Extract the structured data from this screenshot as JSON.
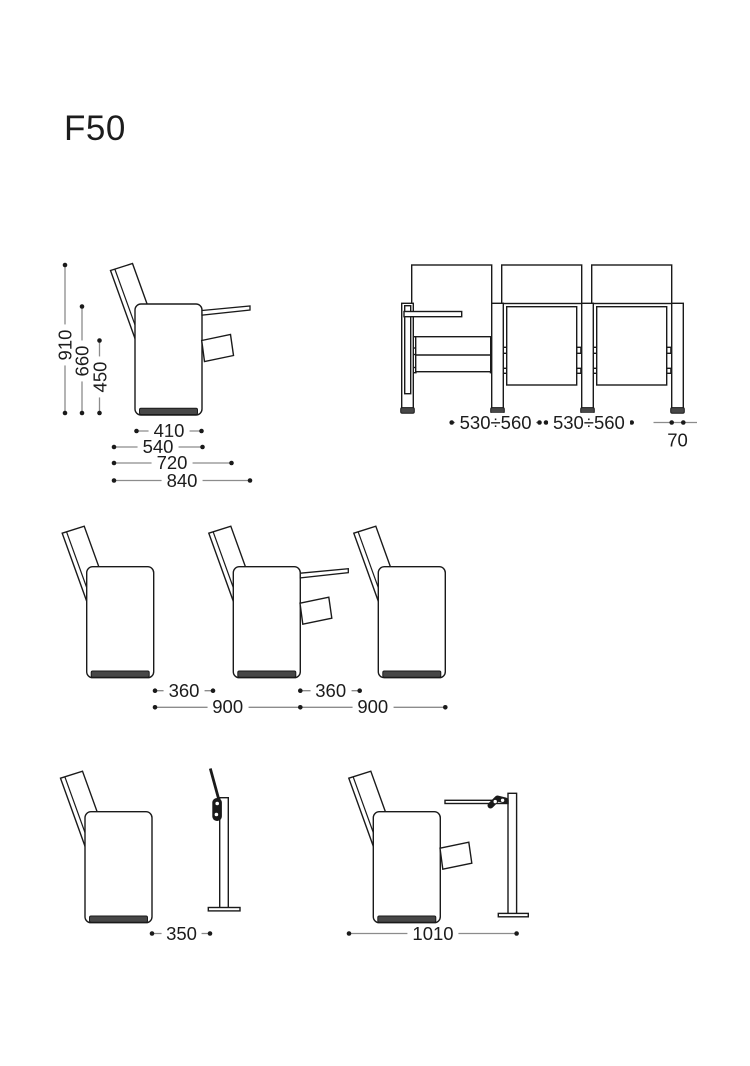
{
  "title": "F50",
  "colors": {
    "line": "#1a1a1a",
    "dim_line": "#8c8c8c",
    "text": "#1c1c1c",
    "base_fill": "#474747",
    "background": "#ffffff"
  },
  "dims": {
    "total_height": "910",
    "armrest_height": "660",
    "seat_height": "450",
    "body_depth": "410",
    "depth_with_backrest": "540",
    "depth_tablet_folded": "720",
    "depth_tablet_open": "840",
    "seat_axis_width_1": "530÷560",
    "seat_axis_width_2": "530÷560",
    "leg_width": "70",
    "row_clearance_1": "360",
    "row_clearance_2": "360",
    "row_spacing_1": "900",
    "row_spacing_2": "900",
    "stand_folded_distance": "350",
    "stand_open_distance": "1010"
  }
}
